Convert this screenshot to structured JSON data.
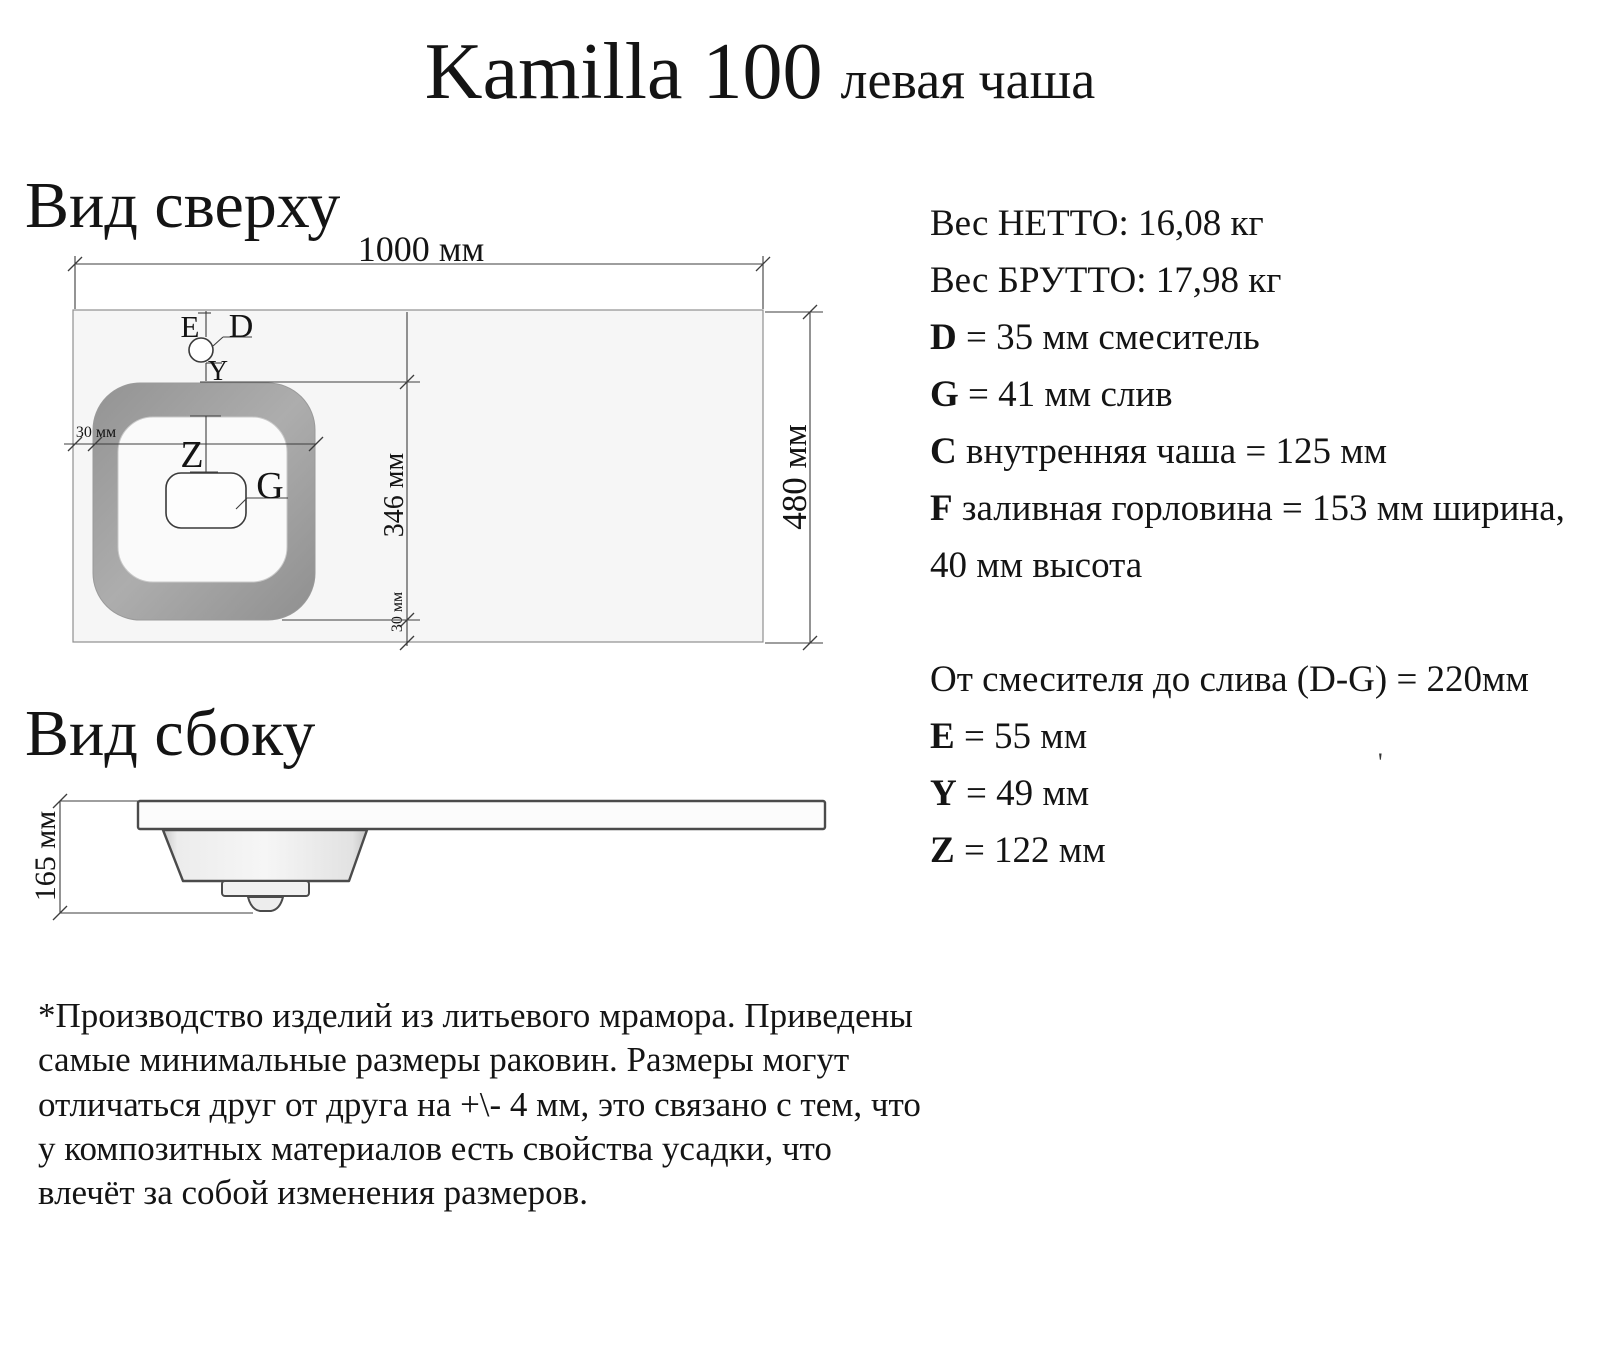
{
  "title": {
    "model": "Kamilla 100",
    "variant": "левая чаша"
  },
  "views": {
    "top": {
      "heading": "Вид сверху",
      "dims": {
        "width": "1000 мм",
        "depth": "480 мм",
        "bowl_depth": "346 мм",
        "edge_left": "30 мм",
        "edge_bottom": "30 мм"
      },
      "markers": {
        "e": "E",
        "d": "D",
        "y": "Y",
        "z": "Z",
        "g": "G"
      }
    },
    "side": {
      "heading": "Вид сбоку",
      "dims": {
        "height": "165 мм"
      }
    }
  },
  "specs": {
    "group1": [
      {
        "prefix": "",
        "text": "Вес НЕТТО: 16,08 кг"
      },
      {
        "prefix": "",
        "text": "Вес БРУТТО: 17,98 кг"
      },
      {
        "prefix": "D",
        "text": " = 35 мм смеситель"
      },
      {
        "prefix": "G",
        "text": " = 41 мм слив"
      },
      {
        "prefix": "C",
        "text": " внутренняя чаша = 125 мм"
      },
      {
        "prefix": "F",
        "text": " заливная горловина = 153 мм ширина,"
      },
      {
        "prefix": "",
        "text": "40 мм высота"
      }
    ],
    "group2": [
      {
        "prefix": "",
        "text": "От смесителя до слива (D-G) = 220мм"
      },
      {
        "prefix": "E",
        "text": " = 55 мм"
      },
      {
        "prefix": "Y",
        "text": " = 49 мм"
      },
      {
        "prefix": "Z",
        "text": " = 122 мм"
      }
    ]
  },
  "footnote": {
    "lines": [
      "*Производство изделий из литьевого мрамора. Приведены",
      "самые минимальные размеры раковин. Размеры могут",
      "отличаться друг от друга на +\\- 4 мм, это связано с тем, что",
      "у композитных материалов есть свойства усадки, что",
      "влечёт за собой изменения размеров."
    ]
  },
  "stray_mark": "'"
}
